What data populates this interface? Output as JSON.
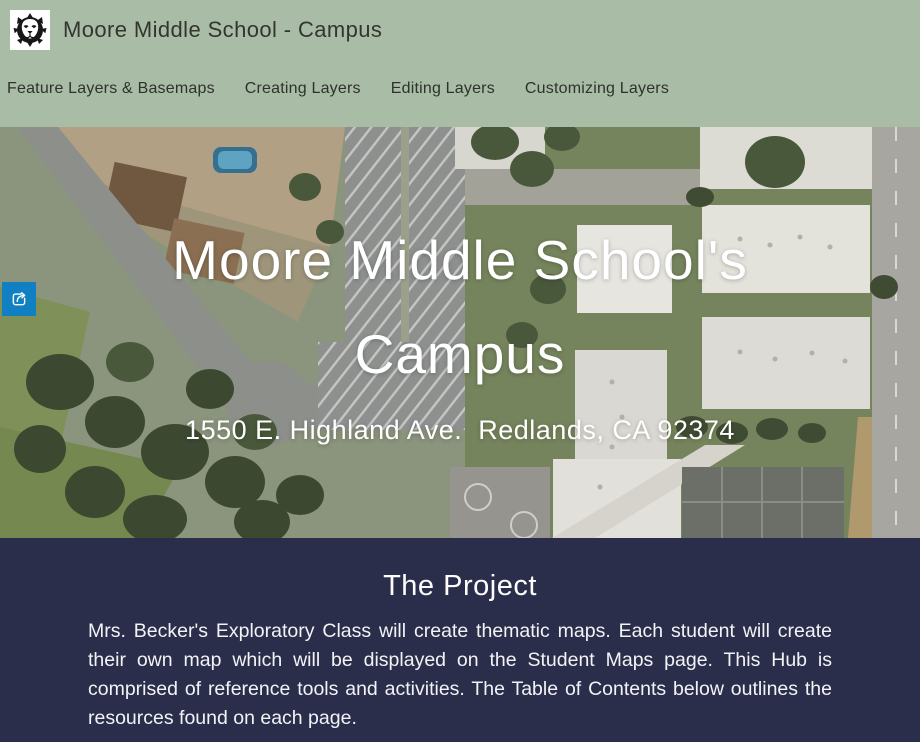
{
  "header": {
    "title": "Moore Middle School - Campus",
    "bg_color": "#a9bca6",
    "nav": [
      {
        "label": "Feature Layers & Basemaps"
      },
      {
        "label": "Creating Layers"
      },
      {
        "label": "Editing Layers"
      },
      {
        "label": "Customizing Layers"
      }
    ]
  },
  "hero": {
    "title_line1": "Moore Middle School's",
    "title_line2": "Campus",
    "subtitle": "1550 E. Highland Ave.  Redlands, CA 92374",
    "share_icon": "export-arrow-square",
    "share_button_color": "#1180c3"
  },
  "project": {
    "heading": "The Project",
    "body": "Mrs. Becker's Exploratory Class will create thematic maps.  Each student will create their own map which will be displayed on the Student Maps page.  This Hub is comprised of reference tools and activities.  The Table of Contents below outlines the resources found on each page.",
    "bg_color": "#2b2e4a"
  }
}
